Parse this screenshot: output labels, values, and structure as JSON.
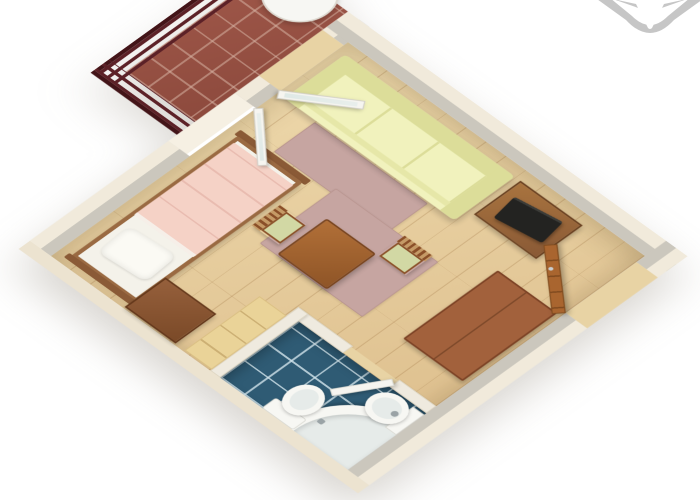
{
  "colors": {
    "background": "#ffffff",
    "floor_light": "#eed9ac",
    "floor_dark": "#ddbe8c",
    "floor_seam": "rgba(150,105,55,0.28)",
    "wall_cream": "#f1eadb",
    "wall_face": "#cbc7bd",
    "wall_light": "#f6f0e3",
    "slab": "#ece3d0",
    "balcony_tile": "#a0584a",
    "balcony_grout": "rgba(214,178,162,0.55)",
    "railing": "#5c2127",
    "railing_dark": "#431418",
    "bed_frame": "#9a6a42",
    "mattress": "#f4f2ea",
    "blanket": "#f5d2c6",
    "blanket_fold": "rgba(221,166,155,0.5)",
    "pillow": "#fbfaf4",
    "sofa": "#f1f2bd",
    "sofa_shade": "#dcdd99",
    "sofa_edge": "#e6e7a8",
    "rug": "#c6a5a1",
    "rug_border": "#b99590",
    "wood_mid": "#a2613c",
    "wood_dark": "#7c4225",
    "table_light": "#b27038",
    "table_dark": "#8f5527",
    "chair_cushion": "#d2d8a4",
    "chair_wood": "#8a4f28",
    "tv_cabinet": "#8a5a36",
    "tv_cabinet_dark": "#6b4222",
    "tv_screen": "#232321",
    "counter": "#ead398",
    "counter_seam": "rgba(150,110,50,0.35)",
    "door_wood": "#a9652f",
    "door_wood_dark": "#7c4a1e",
    "handle": "#c9ced2",
    "bath_tile": "#2f5b74",
    "bath_grout": "rgba(210,228,235,0.8)",
    "fixture": "#f7f7f3",
    "fixture_inner": "#e6ebe9",
    "fixture_border": "#d9d9d2",
    "white_frame": "#f6f5f0",
    "glass": "#dfe9e6",
    "interior_wall": "#efeadf",
    "threshold": "#e8d3a4",
    "logo": "#bcbcbc"
  },
  "scene": {
    "view": "isometric-3d-floorplan",
    "areas": [
      {
        "name": "balcony",
        "floor": "terracotta-tile",
        "items": [
          "slatted-railing",
          "round-table"
        ]
      },
      {
        "name": "living-room",
        "floor": "light-wood-planks",
        "items": [
          "single-bed",
          "pillow",
          "pink-blanket",
          "nightstand",
          "rug-front-of-sofa",
          "rug-center",
          "three-seat-sofa",
          "tv-cabinet",
          "tv",
          "dining-table",
          "chair-left",
          "chair-right",
          "storage-bench",
          "side-counter"
        ]
      },
      {
        "name": "bathroom",
        "floor": "blue-tile",
        "items": [
          "corner-bathtub",
          "toilet",
          "bidet",
          "shower-door-leaf"
        ]
      }
    ],
    "openings": [
      "balcony-door-open",
      "window-open",
      "entrance-door-open",
      "bathroom-doorway"
    ],
    "watermark": "star-logo"
  }
}
